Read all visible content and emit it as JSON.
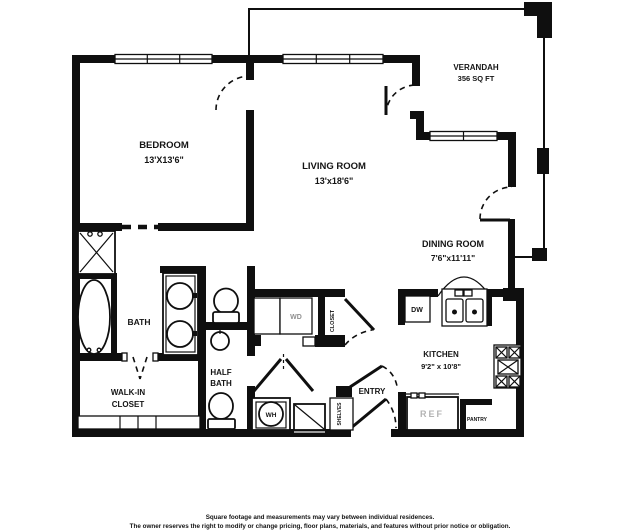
{
  "colors": {
    "wall": "#0f0f0f",
    "background": "#ffffff",
    "muted_gray": "#8a8a8a",
    "ref_text_gray": "#b3b3b3"
  },
  "plan": {
    "rooms": {
      "bedroom": {
        "name": "BEDROOM",
        "dims": "13'X13'6\""
      },
      "living_room": {
        "name": "LIVING ROOM",
        "dims": "13'x18'6\""
      },
      "verandah": {
        "name": "VERANDAH",
        "area": "356 SQ FT"
      },
      "dining_room": {
        "name": "DINING ROOM",
        "dims": "7'6\"x11'11\""
      },
      "kitchen": {
        "name": "KITCHEN",
        "dims": "9'2\" x 10'8\""
      },
      "bath": {
        "name": "BATH"
      },
      "half_bath": {
        "line1": "HALF",
        "line2": "BATH"
      },
      "walk_in_closet": {
        "line1": "WALK-IN",
        "line2": "CLOSET"
      },
      "entry": {
        "name": "ENTRY"
      }
    },
    "fixtures": {
      "washer_dryer": "WD",
      "dishwasher": "DW",
      "refrigerator": "REF",
      "water_heater": "WH",
      "closet": "CLOSET",
      "shelves": "SHELVES",
      "pantry": "PANTRY"
    }
  },
  "footer": {
    "line1": "Square footage and measurements may vary between individual residences.",
    "line2": "The owner reserves the right to modify or change pricing, floor plans, materials, and features without prior notice or obligation."
  }
}
